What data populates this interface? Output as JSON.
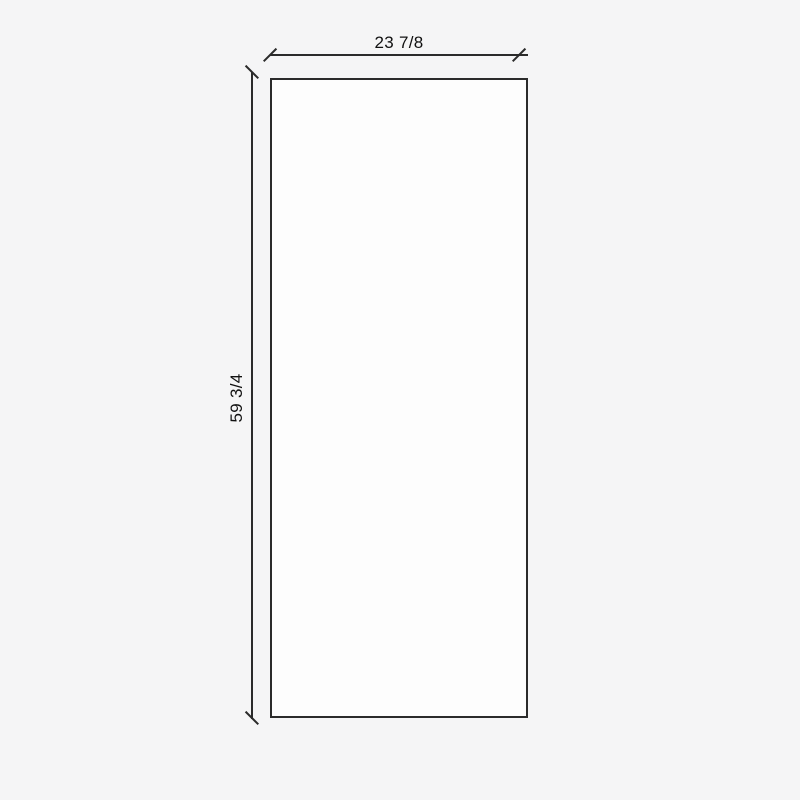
{
  "diagram": {
    "type": "dimensioned-panel-drawing",
    "width_dimension": {
      "label": "23 7/8"
    },
    "height_dimension": {
      "label": "59 3/4"
    }
  },
  "colors": {
    "background": "#f5f5f6",
    "panel_fill": "#fdfdfd",
    "line": "#2b2b2b",
    "text": "#111111"
  }
}
